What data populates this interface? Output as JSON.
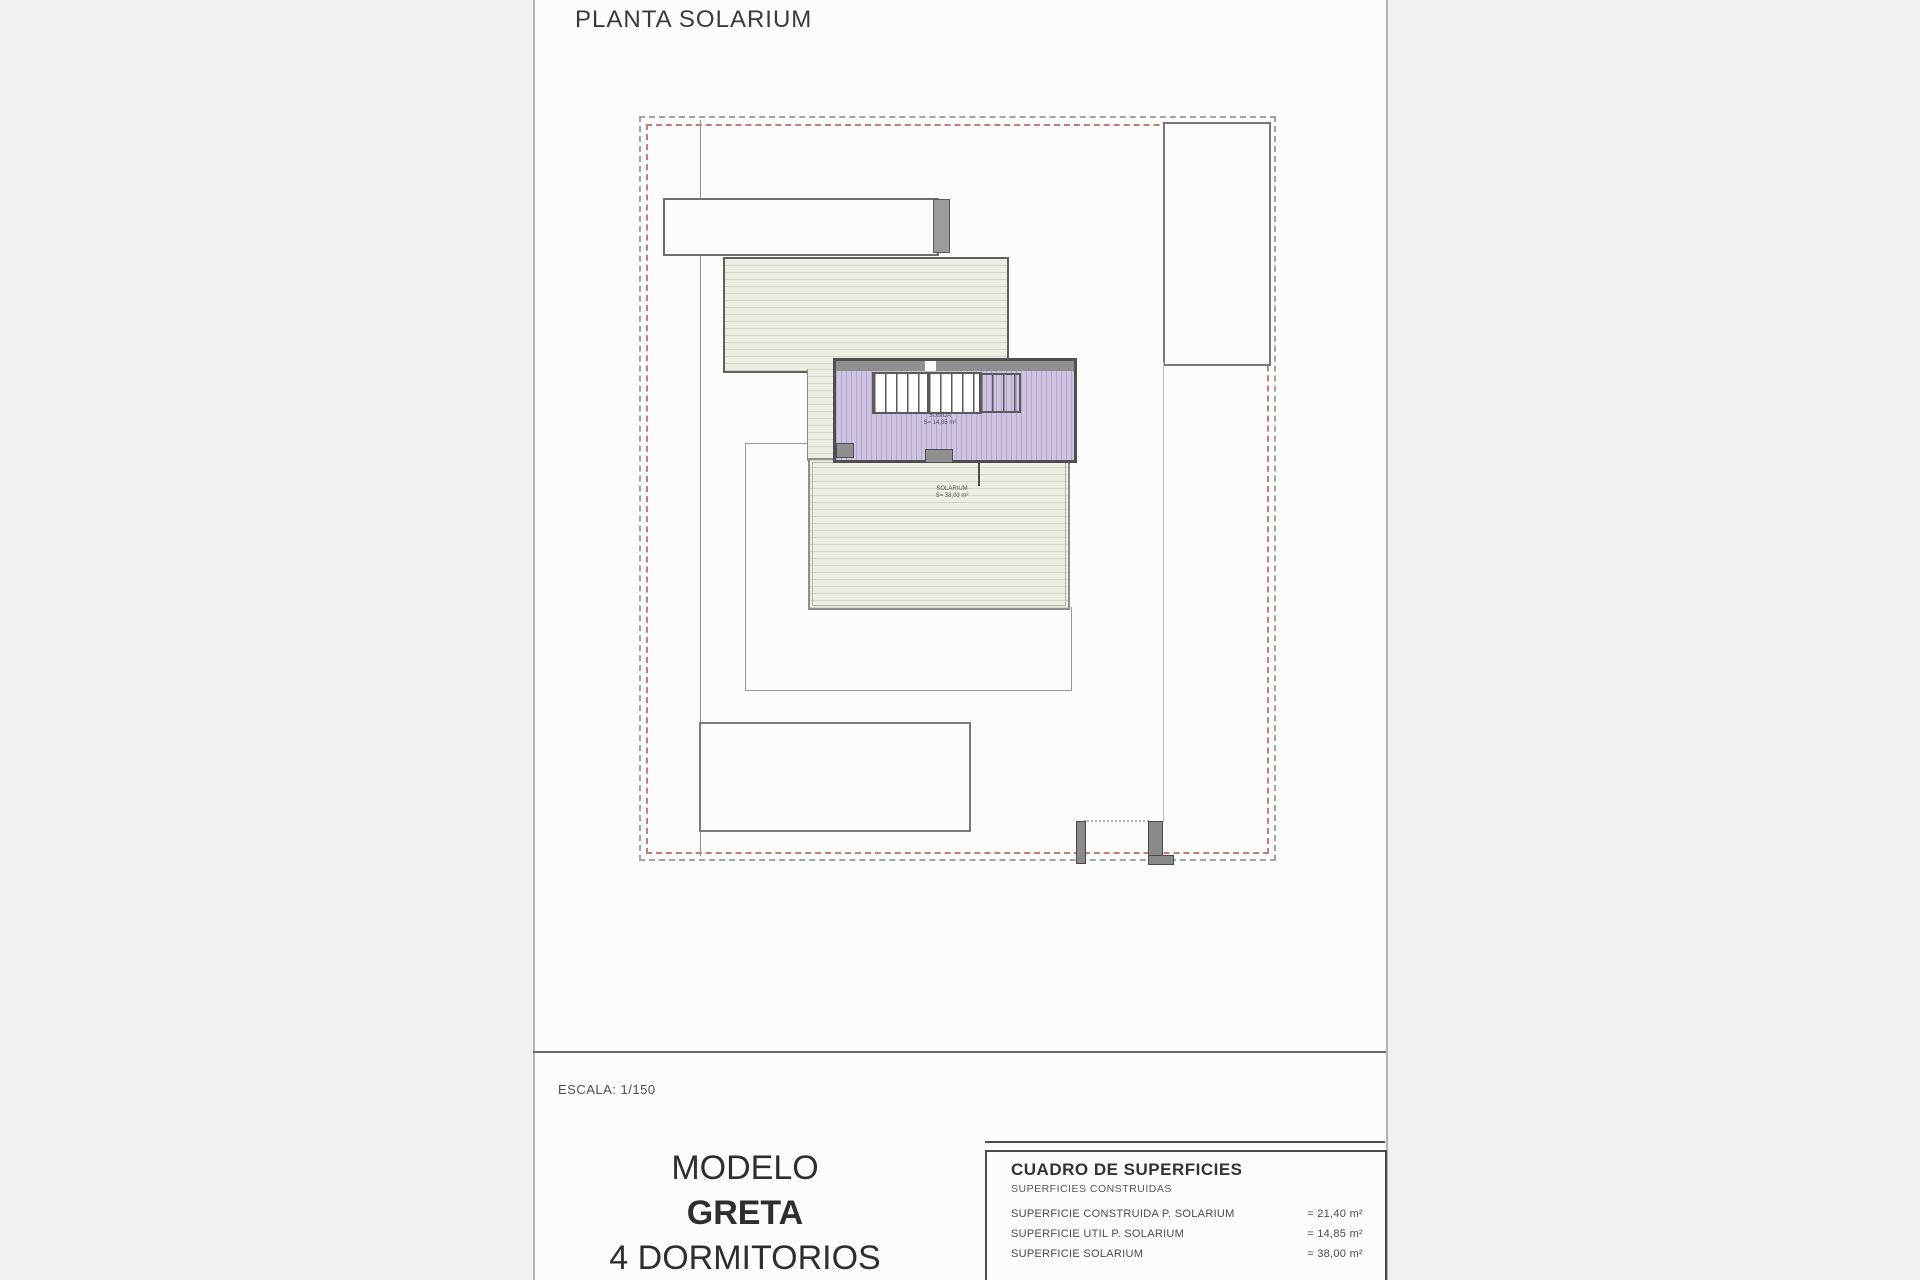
{
  "title": "PLANTA SOLARIUM",
  "plan": {
    "stair_label_line1": "SUBIDA",
    "stair_label_line2": "S= 14,85 m²",
    "deck_label_line1": "SOLARIUM",
    "deck_label_line2": "S= 38,00 m²"
  },
  "scale": "ESCALA: 1/150",
  "model": {
    "prefix": "MODELO",
    "name": "GRETA",
    "bedrooms": "4 DORMITORIOS"
  },
  "surfaces": {
    "title": "CUADRO DE SUPERFICIES",
    "subtitle": "SUPERFICIES CONSTRUIDAS",
    "rows": [
      {
        "label": "SUPERFICIE CONSTRUIDA P. SOLARIUM",
        "value": "= 21,40 m²"
      },
      {
        "label": "SUPERFICIE UTIL P. SOLARIUM",
        "value": "= 14,85 m²"
      },
      {
        "label": "SUPERFICIE SOLARIUM",
        "value": "= 38,00 m²"
      }
    ]
  },
  "colors": {
    "paper": "#fcfcfa",
    "bgray": "#a3a3a3",
    "bred": "#c27e7a",
    "deckfill": "#edeee3",
    "deckline": "#d3d7bf",
    "stairfill": "#cfc3e2",
    "stairline": "#b4a5cf"
  }
}
